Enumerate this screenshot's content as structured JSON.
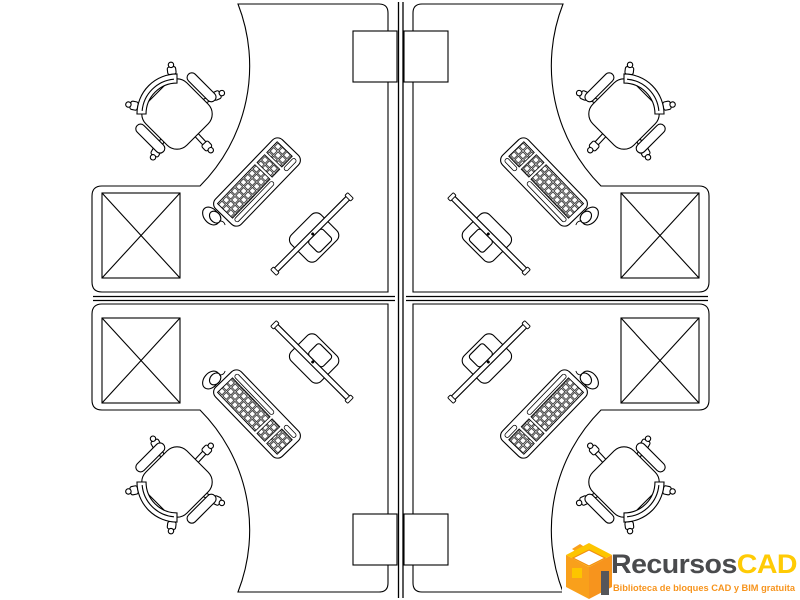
{
  "page": {
    "background": "#ffffff",
    "width_px": 800,
    "height_px": 600,
    "description": "CAD block drawing, plan view of a 4-person office workstation cluster divided by a cross-shaped partition"
  },
  "drawing": {
    "line_color": "#000000",
    "partition": {
      "type": "cross-partition",
      "vertical": "full height",
      "horizontal": "between desk edges"
    },
    "workstations": [
      {
        "id": "top-left",
        "components": [
          "corner-desk",
          "office-chair",
          "file-pedestal-table",
          "cpu-tower",
          "keyboard",
          "mouse",
          "monitor"
        ]
      },
      {
        "id": "top-right",
        "components": [
          "corner-desk",
          "office-chair",
          "file-pedestal-table",
          "cpu-tower",
          "keyboard",
          "mouse",
          "monitor"
        ]
      },
      {
        "id": "bottom-left",
        "components": [
          "corner-desk",
          "office-chair",
          "file-pedestal-table",
          "cpu-tower",
          "keyboard",
          "mouse",
          "monitor"
        ]
      },
      {
        "id": "bottom-right",
        "components": [
          "corner-desk",
          "office-chair",
          "file-pedestal-table",
          "cpu-tower",
          "keyboard",
          "mouse",
          "monitor"
        ]
      }
    ]
  },
  "logo": {
    "brand_primary": "Recursos",
    "brand_accent": "CAD",
    "tagline": "Biblioteca de bloques CAD y BIM gratuita",
    "icon": "isometric-open-box-icon",
    "colors": {
      "primary_text": "#4a4b4d",
      "accent_text": "#ffcb05",
      "tagline_text": "#f7941d",
      "icon_orange": "#f9a01b",
      "icon_gold": "#fdc500",
      "icon_deep_orange": "#f7941d",
      "icon_gray": "#55565a"
    }
  }
}
